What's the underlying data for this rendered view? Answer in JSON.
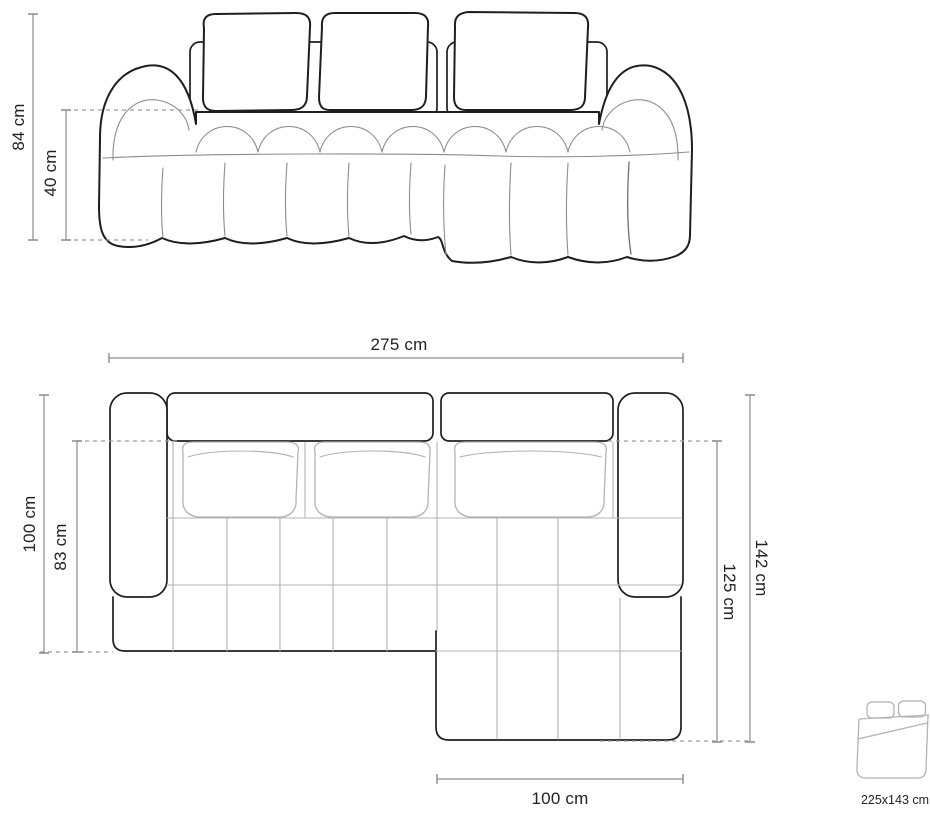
{
  "front_view": {
    "height_label": "84 cm",
    "seat_height_label": "40 cm"
  },
  "top_view": {
    "width_label": "275 cm",
    "depth_label": "100 cm",
    "inner_depth_label": "83 cm",
    "right_depth_label": "142 cm",
    "right_inner_depth_label": "125 cm",
    "chaise_width_label": "100 cm"
  },
  "sleeping_function": {
    "icon": "sofa-bed-icon",
    "size_label": "225x143 cm"
  },
  "colors": {
    "background": "#ffffff",
    "outline": "#1e1e1e",
    "seam": "#8c8c8c",
    "light_seam": "#b3b3b3",
    "dimension": "#8c8c8c",
    "text": "#222222"
  }
}
